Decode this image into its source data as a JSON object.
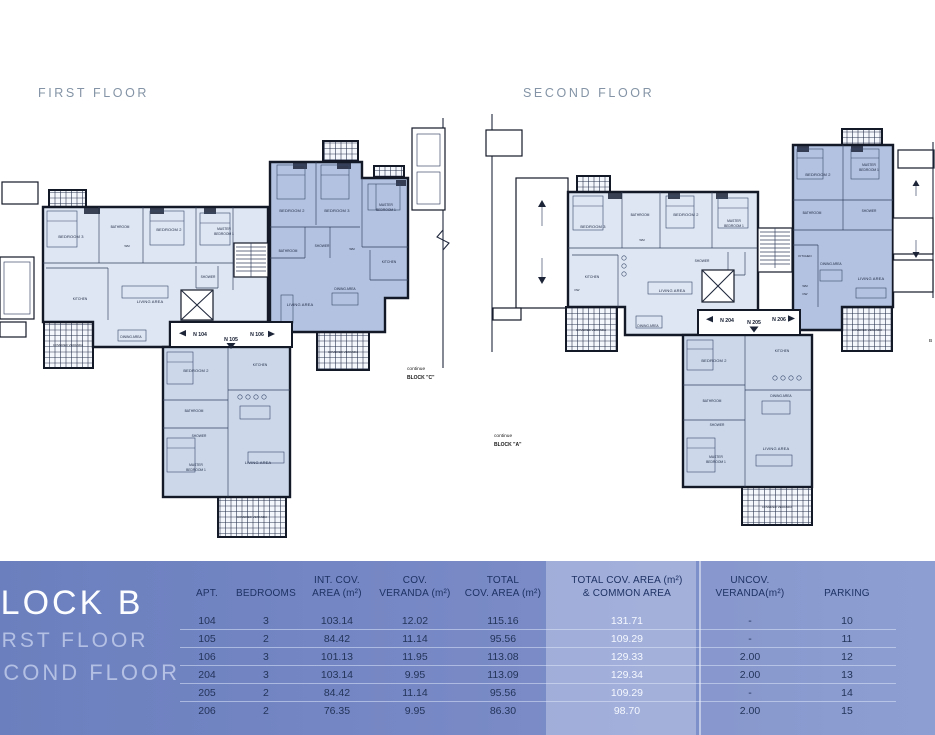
{
  "colors": {
    "band_left": "#6b7fbe",
    "band_right": "#8598cf",
    "highlight_column": "#9dacd8",
    "header_text": "#1e3264",
    "row_text": "#233459",
    "highlight_text": "#f5f8ff",
    "plan_title": "#8494a6",
    "unit_light": "#dde6f2",
    "unit_mid": "#ccd8ea",
    "unit_dark": "#b3c2e0",
    "wall": "#141927"
  },
  "rooms": {
    "bedroom2": "BEDROOM 2",
    "bedroom3": "BEDROOM 3",
    "master1": "MASTER",
    "master2": "BEDROOM 1",
    "bathroom": "BATHROOM",
    "shower": "SHOWER",
    "kitchen": "KITCHEN",
    "living": "LIVING AREA",
    "dining": "DINING AREA",
    "veranda": "COVERED VERANDA",
    "wm": "WM",
    "dw": "DW"
  },
  "floors": {
    "first": {
      "title": "FIRST FLOOR",
      "note1": "continue",
      "note2": "BLOCK \"C\"",
      "entries": [
        "N 104",
        "N 105",
        "N 106"
      ]
    },
    "second": {
      "title": "SECOND FLOOR",
      "note1": "continue",
      "note2": "BLOCK \"A\"",
      "entries": [
        "N 204",
        "N 205",
        "N 206"
      ],
      "partial_label": "B"
    }
  },
  "summary": {
    "block_title": "BLOCK B",
    "floor1": "FIRST FLOOR",
    "floor2": "SECOND FLOOR",
    "table": {
      "headers": [
        {
          "l1": "",
          "l2": "APT."
        },
        {
          "l1": "",
          "l2": "BEDROOMS"
        },
        {
          "l1": "INT. COV.",
          "l2": "AREA (m²)"
        },
        {
          "l1": "COV.",
          "l2": "VERANDA (m²)"
        },
        {
          "l1": "TOTAL",
          "l2": "COV.  AREA (m²)"
        },
        {
          "l1": "TOTAL COV. AREA (m²)",
          "l2": "& COMMON AREA"
        },
        {
          "l1": "UNCOV.",
          "l2": "VERANDA(m²)"
        },
        {
          "l1": "",
          "l2": "PARKING"
        }
      ],
      "rows": [
        [
          "104",
          "3",
          "103.14",
          "12.02",
          "115.16",
          "131.71",
          "-",
          "10"
        ],
        [
          "105",
          "2",
          "84.42",
          "11.14",
          "95.56",
          "109.29",
          "-",
          "11"
        ],
        [
          "106",
          "3",
          "101.13",
          "11.95",
          "113.08",
          "129.33",
          "2.00",
          "12"
        ],
        [
          "204",
          "3",
          "103.14",
          "9.95",
          "113.09",
          "129.34",
          "2.00",
          "13"
        ],
        [
          "205",
          "2",
          "84.42",
          "11.14",
          "95.56",
          "109.29",
          "-",
          "14"
        ],
        [
          "206",
          "2",
          "76.35",
          "9.95",
          "86.30",
          "98.70",
          "2.00",
          "15"
        ]
      ]
    }
  }
}
